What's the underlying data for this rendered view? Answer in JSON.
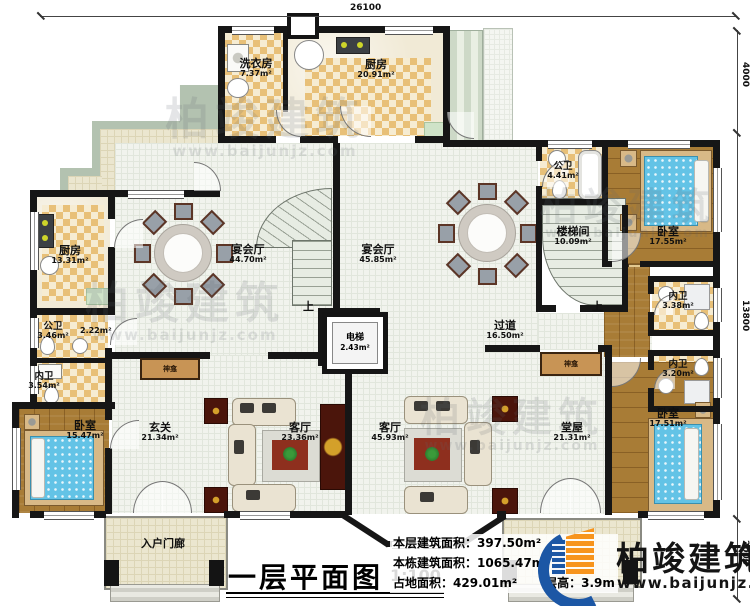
{
  "title_block": {
    "title": "一层平面图",
    "scale": "1:100"
  },
  "stats": [
    {
      "label": "本层建筑面积：",
      "value": "397.50m²"
    },
    {
      "label": "本栋建筑面积：",
      "value": "1065.47m²"
    },
    {
      "label": "占地面积：",
      "value": "429.01m²"
    },
    {
      "label": "层高：",
      "value": "3.9m"
    }
  ],
  "brand": {
    "name": "柏竣建筑",
    "website": "www.baijunjz.com"
  },
  "watermark": {
    "name": "柏竣建筑",
    "website": "www.baijunjz.com"
  },
  "dimensions": {
    "top": "26100",
    "right_upper": "4000",
    "right_middle": "13800",
    "right_lower": "2000"
  },
  "misc": {
    "up": "上",
    "shrine": "神龛",
    "closet_area": "2.22m²"
  },
  "rooms": [
    {
      "name": "洗衣房",
      "area": "7.37m²"
    },
    {
      "name": "厨房",
      "area": "20.91m²"
    },
    {
      "name": "厨房",
      "area": "13.31m²"
    },
    {
      "name": "宴会厅",
      "area": "44.70m²"
    },
    {
      "name": "宴会厅",
      "area": "45.85m²"
    },
    {
      "name": "公卫",
      "area": "4.41m²"
    },
    {
      "name": "楼梯间",
      "area": "10.09m²"
    },
    {
      "name": "卧室",
      "area": "17.55m²"
    },
    {
      "name": "内卫",
      "area": "3.38m²"
    },
    {
      "name": "公卫",
      "area": "3.46m²"
    },
    {
      "name": "内卫",
      "area": "3.54m²"
    },
    {
      "name": "电梯",
      "area": "2.43m²"
    },
    {
      "name": "过道",
      "area": "16.50m²"
    },
    {
      "name": "内卫",
      "area": "3.20m²"
    },
    {
      "name": "卧室",
      "area": "15.47m²"
    },
    {
      "name": "玄关",
      "area": "21.34m²"
    },
    {
      "name": "客厅",
      "area": "23.36m²"
    },
    {
      "name": "客厅",
      "area": "45.93m²"
    },
    {
      "name": "堂屋",
      "area": "21.31m²"
    },
    {
      "name": "卧室",
      "area": "17.51m²"
    },
    {
      "name": "入户门廊",
      "area": ""
    },
    {
      "name": "入户门廊",
      "area": ""
    }
  ]
}
